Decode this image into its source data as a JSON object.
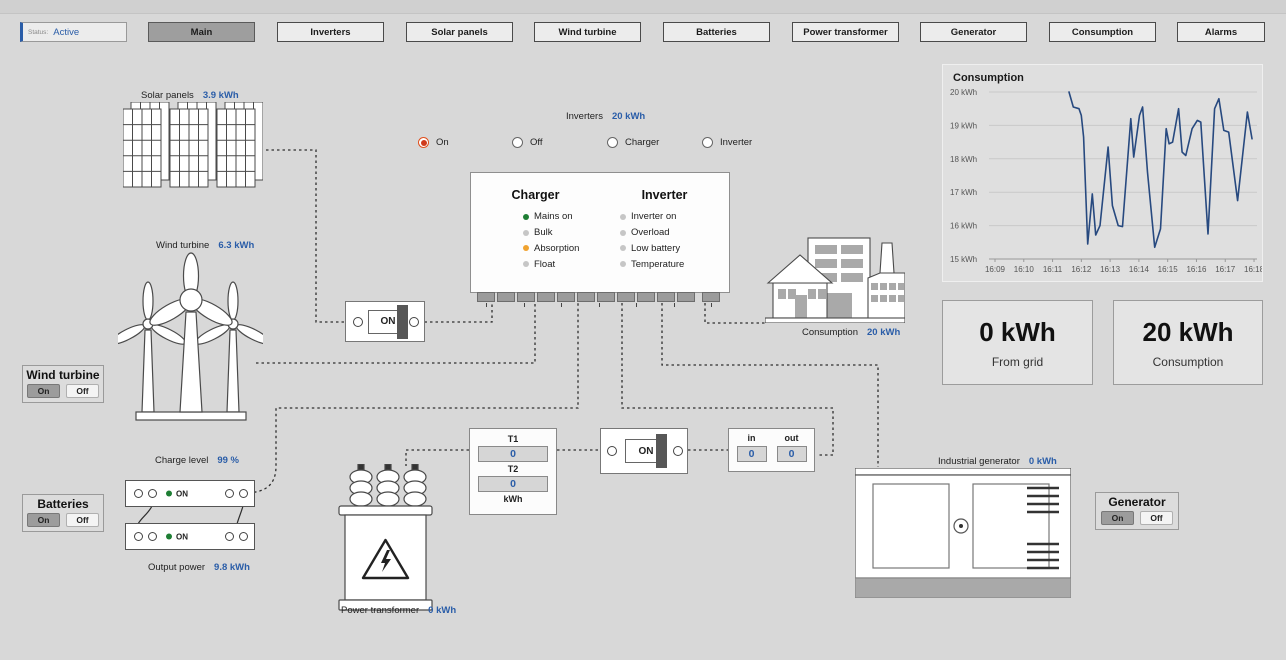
{
  "colors": {
    "accent_blue": "#2a5da8",
    "chart_line": "#27497f",
    "led_green": "#1e7e34",
    "led_orange": "#f0a330",
    "led_gray": "#c6c6c6",
    "radio_selected": "#cf3a1c"
  },
  "toolbar": {
    "status_label": "Status:",
    "status_value": "Active",
    "buttons": [
      {
        "label": "Main",
        "active": true
      },
      {
        "label": "Inverters",
        "active": false
      },
      {
        "label": "Solar panels",
        "active": false
      },
      {
        "label": "Wind turbine",
        "active": false
      },
      {
        "label": "Batteries",
        "active": false
      },
      {
        "label": "Power transformer",
        "active": false
      },
      {
        "label": "Generator",
        "active": false
      },
      {
        "label": "Consumption",
        "active": false
      },
      {
        "label": "Alarms",
        "active": false
      }
    ]
  },
  "solar": {
    "label": "Solar panels",
    "value": "3.9 kWh"
  },
  "wind": {
    "label": "Wind turbine",
    "value": "6.3 kWh"
  },
  "inverters": {
    "label": "Inverters",
    "value": "20 kWh",
    "radios": [
      {
        "label": "On",
        "selected": true
      },
      {
        "label": "Off",
        "selected": false
      },
      {
        "label": "Charger",
        "selected": false
      },
      {
        "label": "Inverter",
        "selected": false
      }
    ],
    "status_panel": {
      "charger_title": "Charger",
      "inverter_title": "Inverter",
      "charger_items": [
        {
          "label": "Mains on",
          "color": "#1e7e34"
        },
        {
          "label": "Bulk",
          "color": "#c6c6c6"
        },
        {
          "label": "Absorption",
          "color": "#f0a330"
        },
        {
          "label": "Float",
          "color": "#c6c6c6"
        }
      ],
      "inverter_items": [
        {
          "label": "Inverter on",
          "color": "#c6c6c6"
        },
        {
          "label": "Overload",
          "color": "#c6c6c6"
        },
        {
          "label": "Low battery",
          "color": "#c6c6c6"
        },
        {
          "label": "Temperature",
          "color": "#c6c6c6"
        }
      ]
    }
  },
  "wind_panel": {
    "title": "Wind turbine",
    "on": "On",
    "off": "Off",
    "on_selected": true
  },
  "batteries_panel": {
    "title": "Batteries",
    "on": "On",
    "off": "Off",
    "on_selected": true
  },
  "generator_panel": {
    "title": "Generator",
    "on": "On",
    "off": "Off",
    "on_selected": true
  },
  "battery": {
    "charge_label": "Charge level",
    "charge_value": "99 %",
    "unit_status": "ON",
    "output_label": "Output power",
    "output_value": "9.8 kWh"
  },
  "switches": {
    "switch1": "ON",
    "switch2": "ON"
  },
  "transformer_meter": {
    "t1_label": "T1",
    "t1_value": "0",
    "t2_label": "T2",
    "t2_value": "0",
    "unit": "kWh"
  },
  "grid_meter": {
    "in_label": "in",
    "in_value": "0",
    "out_label": "out",
    "out_value": "0"
  },
  "transformer": {
    "label": "Power transformer",
    "value": "0 kWh"
  },
  "consumption_site": {
    "label": "Consumption",
    "value": "20 kWh"
  },
  "generator": {
    "label": "Industrial generator",
    "value": "0 kWh"
  },
  "kpis": [
    {
      "value": "0 kWh",
      "label": "From grid"
    },
    {
      "value": "20 kWh",
      "label": "Consumption"
    }
  ],
  "chart_data": {
    "type": "line",
    "title": "Consumption",
    "xlabel": "",
    "ylabel": "",
    "ylim": [
      15,
      20
    ],
    "grid": "horizontal",
    "legend": "none",
    "line_color": "#27497f",
    "yticks": [
      "20 kWh",
      "19 kWh",
      "18 kWh",
      "17 kWh",
      "16 kWh",
      "15 kWh"
    ],
    "xticks": [
      "16:09",
      "16:10",
      "16:11",
      "16:12",
      "16:13",
      "16:14",
      "16:15",
      "16:16",
      "16:17",
      "16:18"
    ],
    "series": [
      {
        "name": "Consumption",
        "x": [
          11.57,
          11.72,
          11.92,
          12.0,
          12.08,
          12.22,
          12.38,
          12.5,
          12.65,
          12.93,
          13.08,
          13.28,
          13.43,
          13.72,
          13.82,
          14.02,
          14.13,
          14.3,
          14.55,
          14.75,
          14.95,
          15.05,
          15.17,
          15.38,
          15.5,
          15.63,
          15.85,
          16.03,
          16.15,
          16.4,
          16.63,
          16.78,
          16.95,
          17.12,
          17.43,
          17.77,
          17.93
        ],
        "y": [
          20.0,
          19.55,
          19.5,
          19.3,
          18.65,
          15.45,
          16.95,
          15.72,
          16.0,
          18.35,
          16.6,
          16.0,
          15.97,
          19.2,
          18.05,
          19.3,
          19.55,
          17.6,
          15.35,
          15.9,
          18.9,
          18.45,
          18.5,
          19.5,
          18.2,
          18.1,
          18.9,
          19.15,
          19.1,
          15.75,
          19.5,
          19.8,
          18.85,
          18.8,
          16.75,
          19.4,
          18.6
        ]
      }
    ]
  }
}
